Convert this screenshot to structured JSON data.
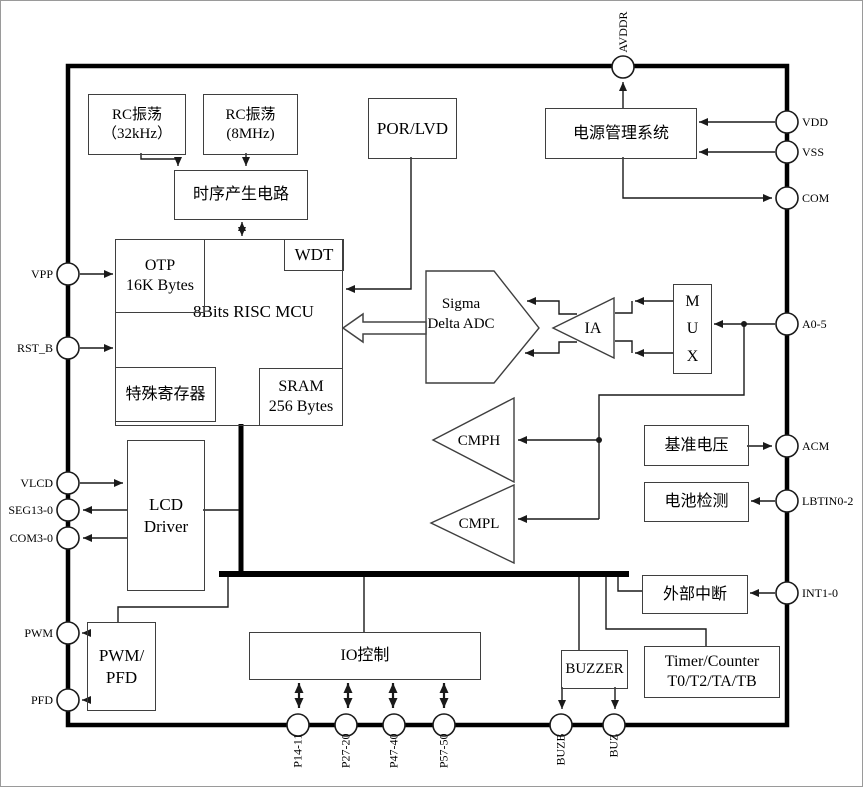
{
  "blocks": {
    "rc32": {
      "line1": "RC振荡",
      "line2": "（32kHz）"
    },
    "rc8": {
      "line1": "RC振荡",
      "line2": "(8MHz)"
    },
    "timing": {
      "label": "时序产生电路"
    },
    "por_lvd": {
      "label": "POR/LVD"
    },
    "power_mgmt": {
      "label": "电源管理系统"
    },
    "mcu": {
      "line1": "8Bits",
      "line2": "RISC MCU"
    },
    "otp": {
      "line1": "OTP",
      "line2": "16K Bytes"
    },
    "wdt": {
      "label": "WDT"
    },
    "sfr": {
      "label": "特殊寄存器"
    },
    "sram": {
      "line1": "SRAM",
      "line2": "256 Bytes"
    },
    "adc": {
      "line1": "Sigma",
      "line2": "Delta",
      "line3": "ADC"
    },
    "ia": {
      "label": "IA"
    },
    "mux": {
      "line1": "M",
      "line2": "U",
      "line3": "X"
    },
    "cmph": {
      "label": "CMPH"
    },
    "cmpl": {
      "label": "CMPL"
    },
    "vref": {
      "label": "基准电压"
    },
    "battery_detect": {
      "label": "电池检测"
    },
    "lcd_driver": {
      "line1": "LCD",
      "line2": "Driver"
    },
    "ext_interrupt": {
      "label": "外部中断"
    },
    "pwm_pfd": {
      "line1": "PWM/",
      "line2": "PFD"
    },
    "io_control": {
      "label": "IO控制"
    },
    "buzzer": {
      "label": "BUZZER"
    },
    "timer": {
      "line1": "Timer/Counter",
      "line2": "T0/T2/TA/TB"
    }
  },
  "pins": {
    "avddr": "AVDDR",
    "vdd": "VDD",
    "vss": "VSS",
    "com": "COM",
    "a0_5": "A0-5",
    "acm": "ACM",
    "lbtin0_2": "LBTIN0-2",
    "int1_0": "INT1-0",
    "vpp": "VPP",
    "rst_b": "RST_B",
    "vlcd": "VLCD",
    "seg13_0": "SEG13-0",
    "com3_0": "COM3-0",
    "pwm": "PWM",
    "pfd": "PFD",
    "p14_11": "P14-11",
    "p27_20": "P27-20",
    "p47_40": "P47-40",
    "p57_50": "P57-50",
    "buzb": "BUZB",
    "buz": "BUZ"
  },
  "colors": {
    "line": "#1a1a1a",
    "box_border": "#3f3f3f",
    "chip_border": "#000000",
    "background": "#ffffff"
  }
}
